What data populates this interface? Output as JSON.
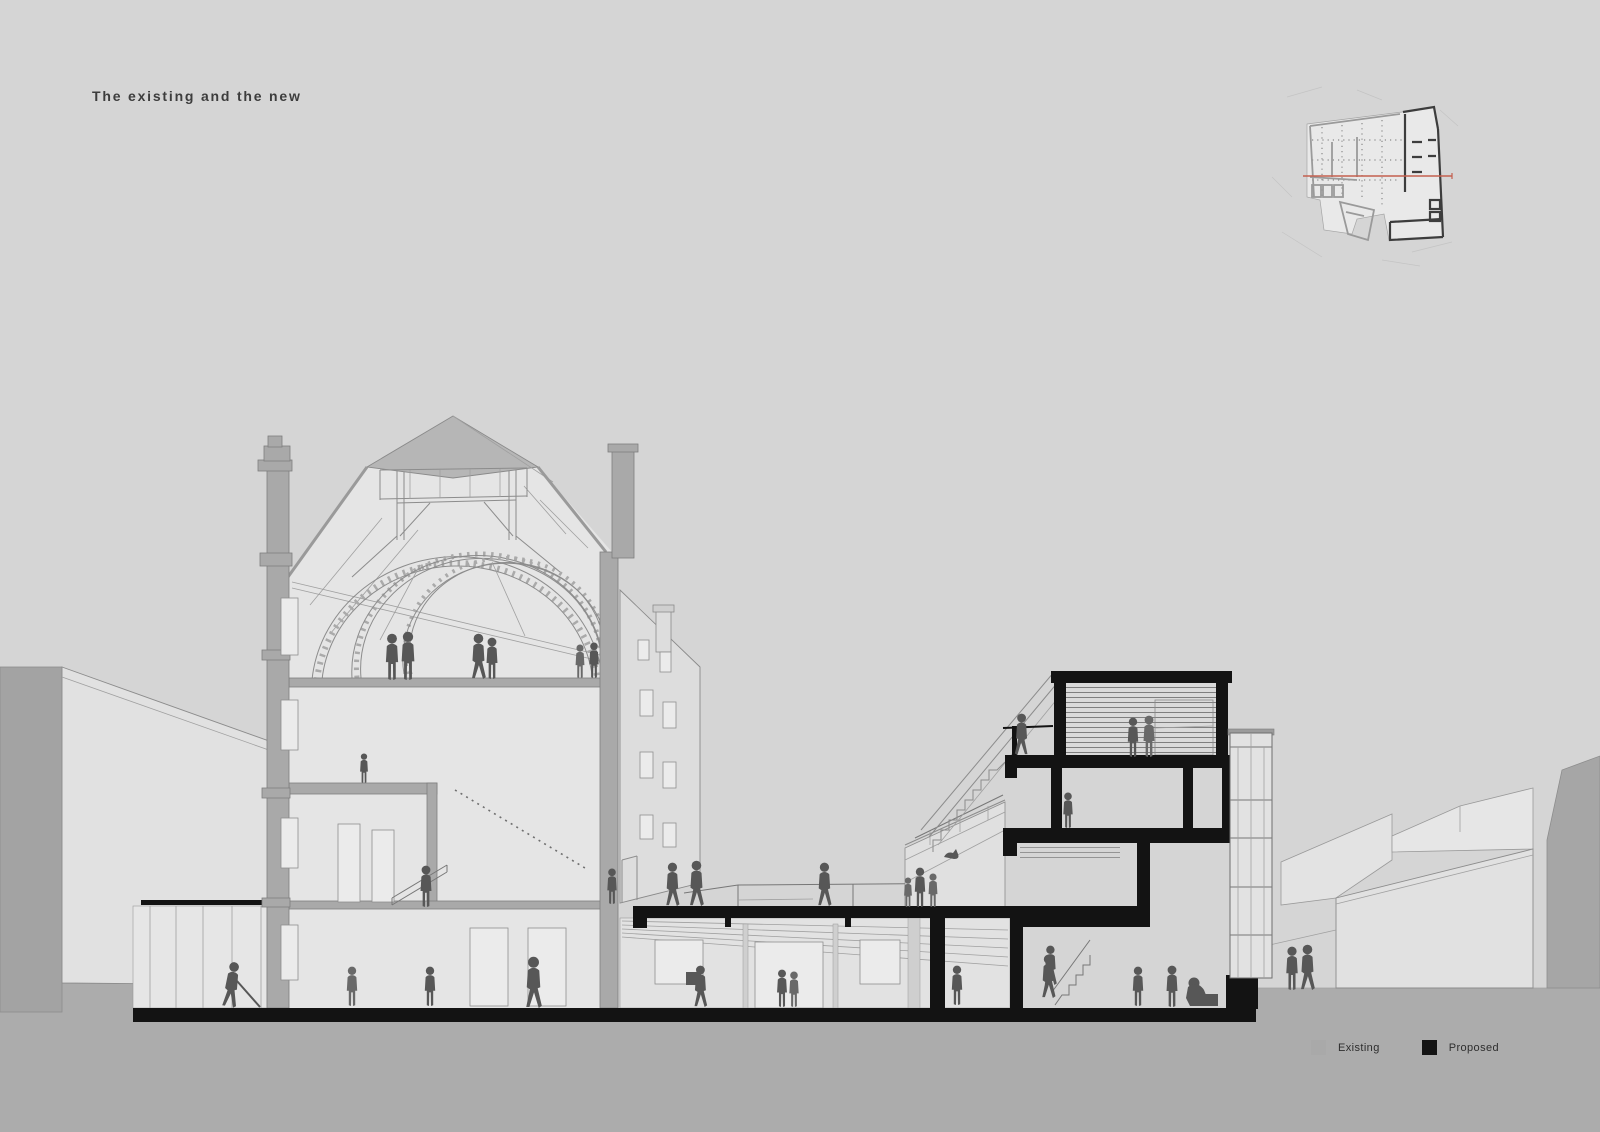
{
  "title": "The existing and the new",
  "legend": {
    "items": [
      {
        "id": "existing",
        "label": "Existing",
        "color": "#a9a9a9"
      },
      {
        "id": "proposed",
        "label": "Proposed",
        "color": "#141414"
      }
    ]
  },
  "key_plan": {
    "description": "Site key plan with red section cut line",
    "section_line_color": "#c4604f"
  },
  "palette": {
    "background": "#d5d5d5",
    "ground": "#acacac",
    "existing_cut": "#a9a9a9",
    "proposed": "#141414",
    "figures": "#575757",
    "section_line": "#c4604f"
  }
}
